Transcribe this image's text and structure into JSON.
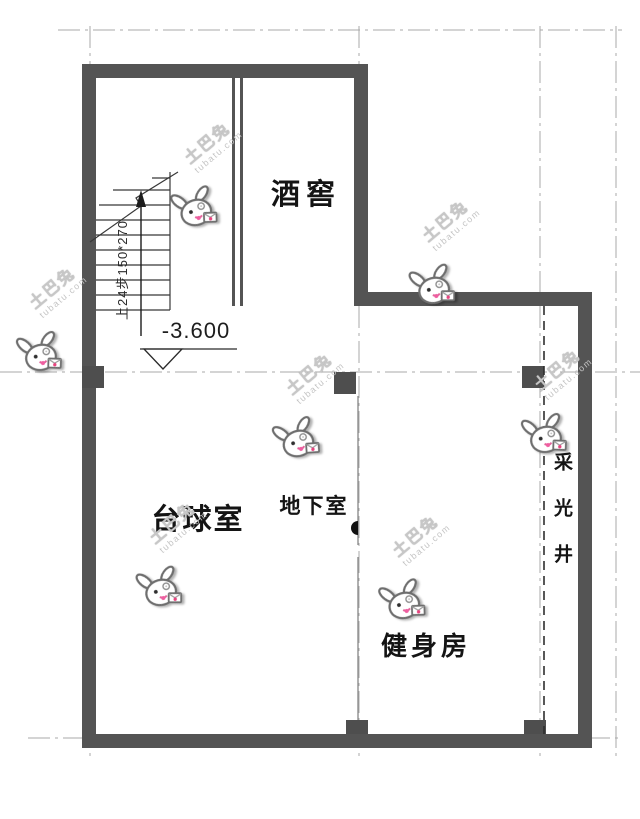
{
  "plan": {
    "rooms": {
      "wine_cellar": "酒窖",
      "billiards": "台球室",
      "basement": "地下室",
      "gym": "健身房",
      "light_well": "采光井"
    },
    "elevation": "-3.600",
    "stair_note": "上24步150*270"
  },
  "watermark": {
    "brand": "土巴兔",
    "domain": "tubatu.com",
    "instances": [
      {
        "x": 197,
        "y": 207,
        "rot": -18
      },
      {
        "x": 42,
        "y": 352,
        "rot": -14
      },
      {
        "x": 435,
        "y": 285,
        "rot": -16
      },
      {
        "x": 299,
        "y": 438,
        "rot": -20
      },
      {
        "x": 547,
        "y": 434,
        "rot": -14
      },
      {
        "x": 162,
        "y": 587,
        "rot": -16
      },
      {
        "x": 405,
        "y": 600,
        "rot": -18
      }
    ]
  }
}
